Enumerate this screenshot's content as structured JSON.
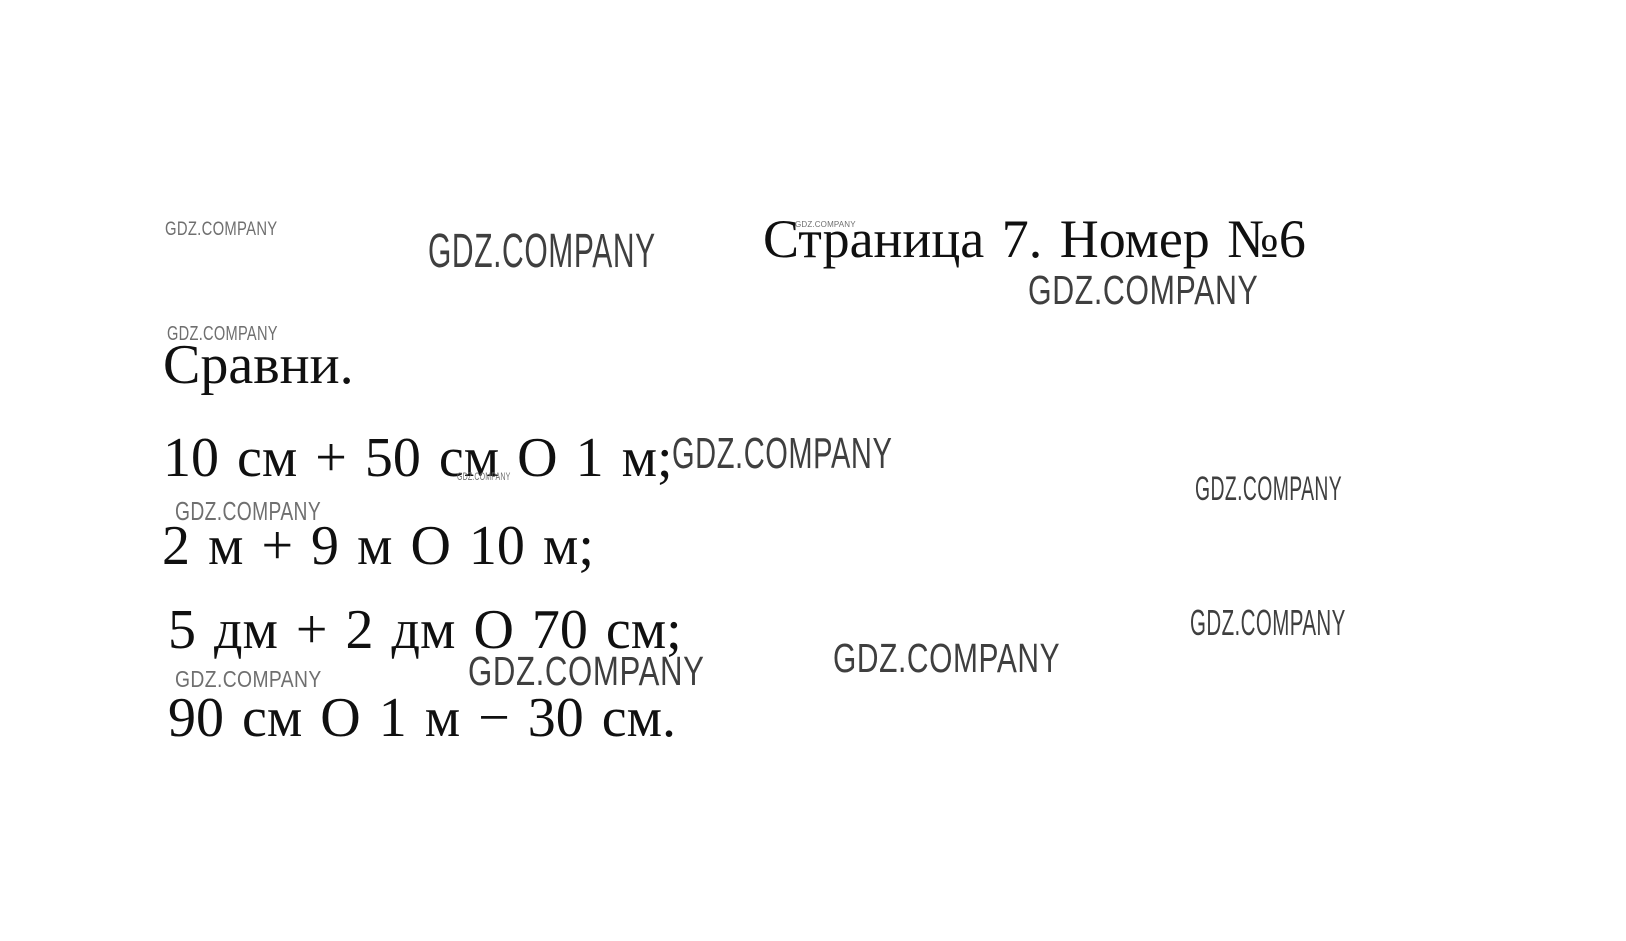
{
  "page": {
    "background": "#ffffff",
    "text_color": "#101010",
    "watermark_color_dark": "#3f3f3f",
    "watermark_color_light": "#6f6f6f",
    "title": "Страница 7. Номер №6",
    "task_label": "Сравни.",
    "exercise_lines": [
      "10 см + 50 см О 1 м;",
      "2 м + 9 м О 10 м;",
      "5 дм + 2 дм О 70 см;",
      "90 см О 1 м − 30 см."
    ],
    "watermark_text": "GDZ.COMPANY"
  }
}
